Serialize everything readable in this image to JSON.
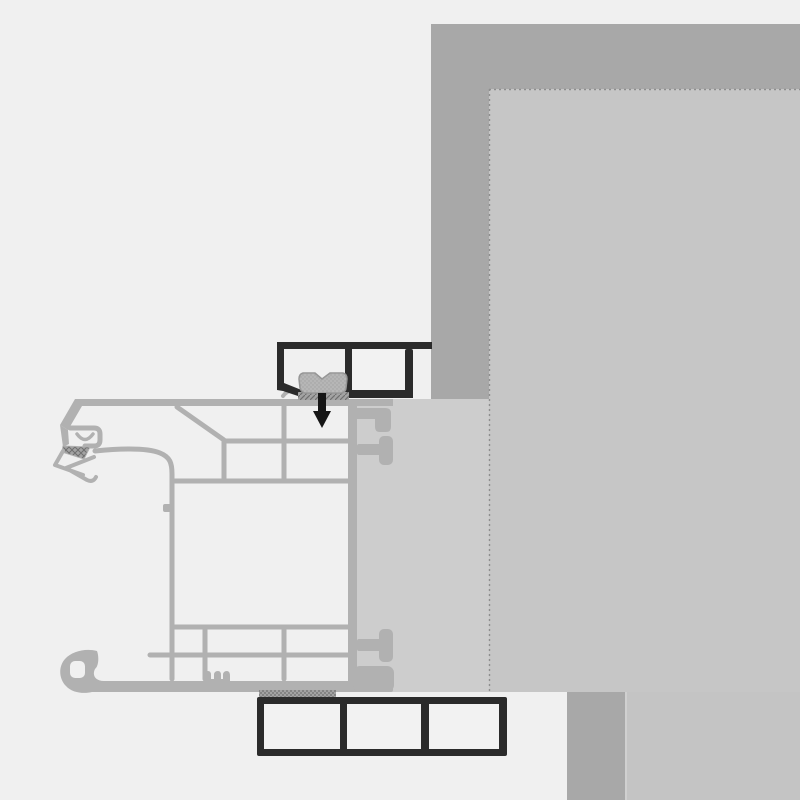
{
  "colors": {
    "background": "#f0f0f0",
    "wall_dark": "#a8a8a8",
    "wall_inner": "#c6c6c6",
    "wall_reveal": "#cdcdcd",
    "wall_slab": "#c4c4c4",
    "frame_gray": "#b1b1b1",
    "trim_black": "#2b2b2b",
    "trim_fill": "#f2f2f2",
    "clamp_gray": "#b6b6b6",
    "clamp_outline": "#959595",
    "clamp_dot": "#a0a0a0",
    "screw_black": "#161616",
    "dash_gray": "#8e8e8e",
    "hatch_base": "#a3a3a3",
    "hatch_dark": "#6f6f6f",
    "seam_light": "#d4d4d4"
  }
}
